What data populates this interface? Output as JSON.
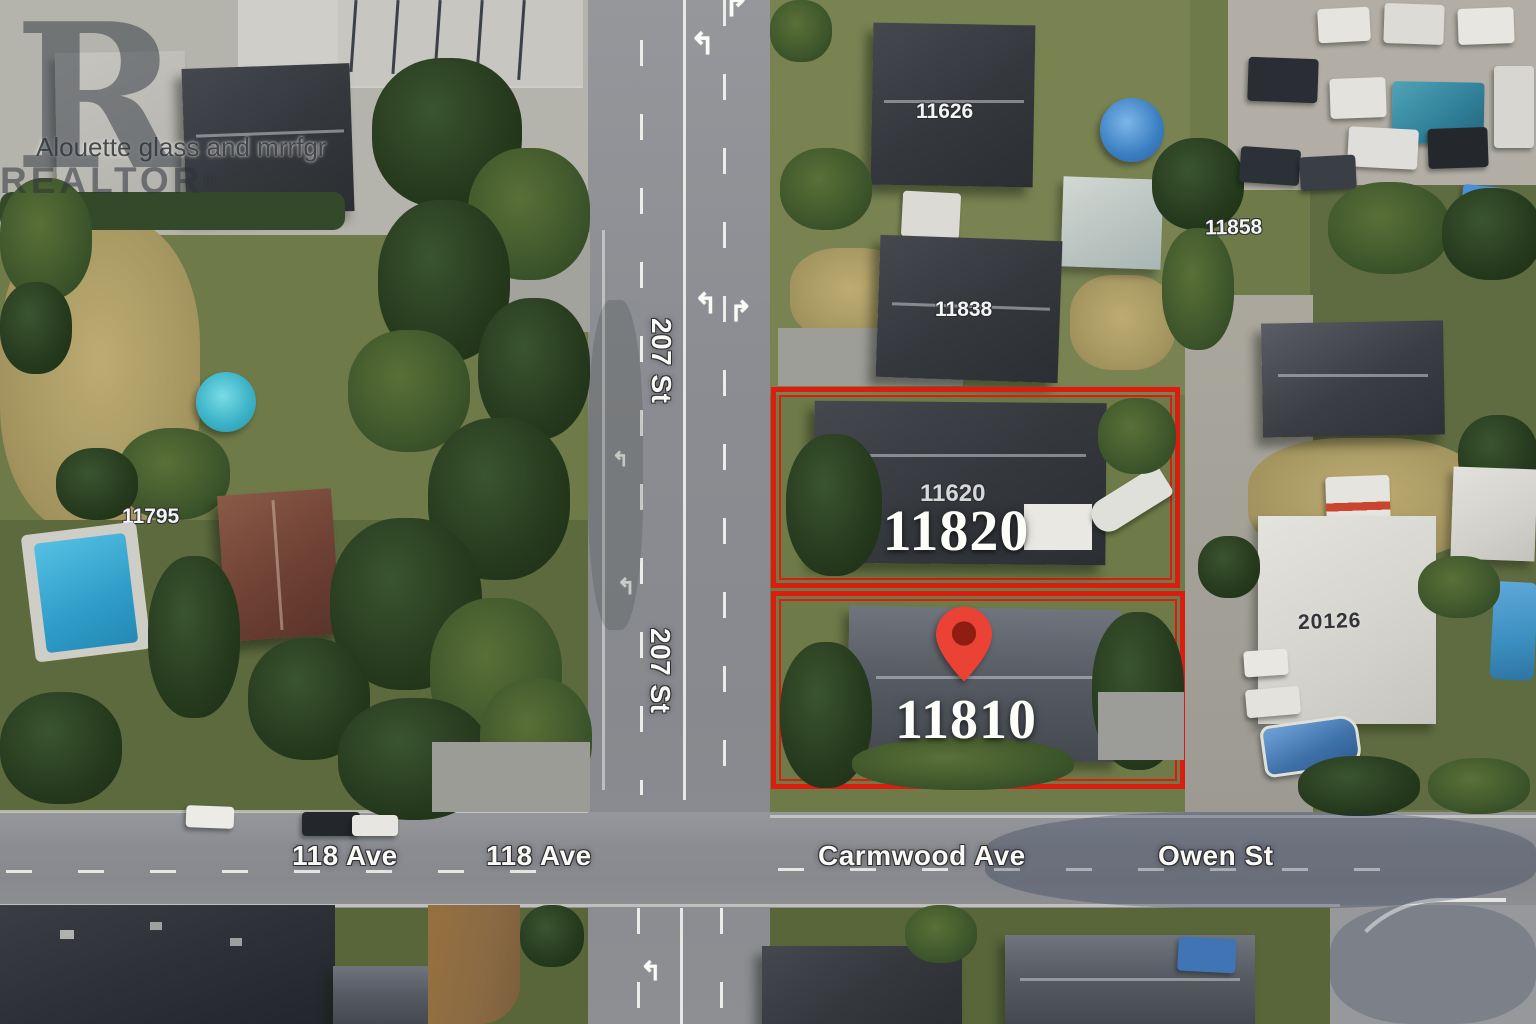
{
  "watermark": {
    "letter": "R",
    "brand": "REALTOR",
    "registered": "®"
  },
  "poi_label": "Alouette glass and mrrfgr",
  "map_labels": {
    "street_207_a": "207 St",
    "street_207_b": "207 St",
    "ave_118_a": "118 Ave",
    "ave_118_b": "118 Ave",
    "carmwood": "Carmwood Ave",
    "owen": "Owen St"
  },
  "parcel_labels": {
    "north": "11820",
    "south": "11810"
  },
  "house_numbers": {
    "h11626": "11626",
    "h11858": "11858",
    "h11838": "11838",
    "h11795": "11795",
    "h11620": "11620",
    "h20126": "20126"
  },
  "colors": {
    "parcel_outline": "#dd1c10",
    "pin_red": "#ea4335",
    "pin_core": "#8f1d12"
  }
}
